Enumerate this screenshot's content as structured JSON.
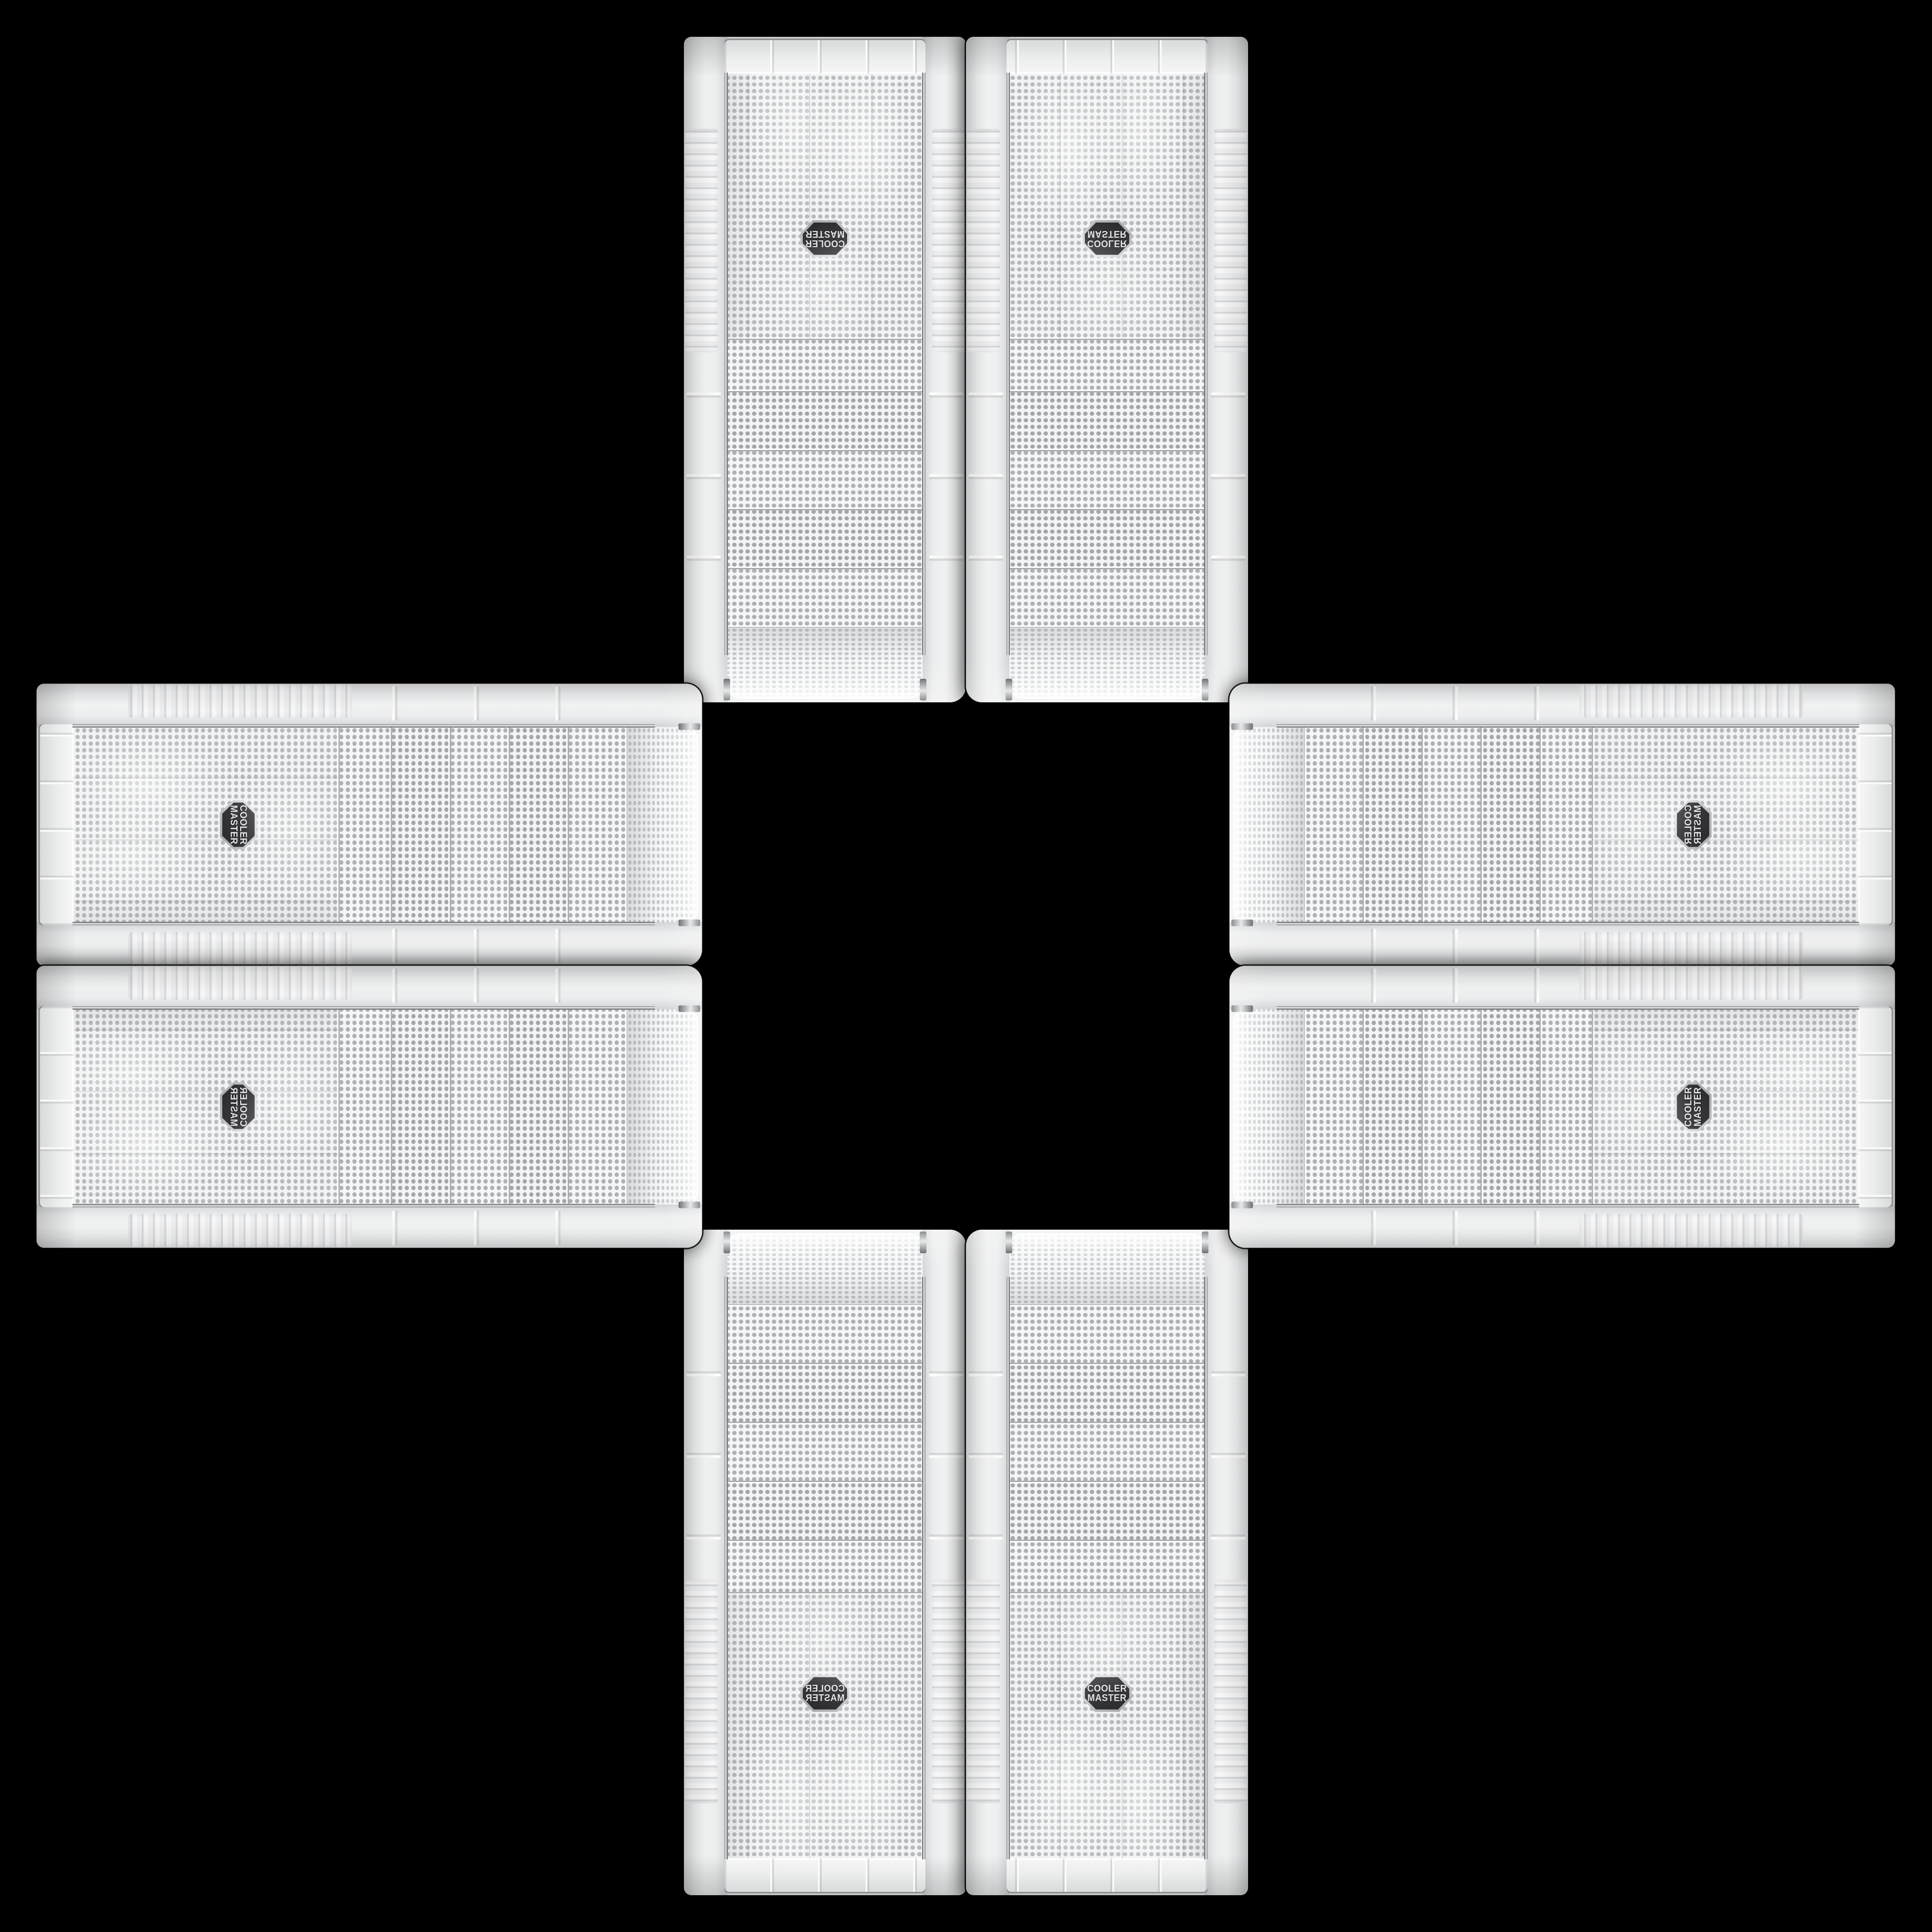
{
  "scene": {
    "type": "product-photo-collage",
    "description": "Eight identical white Cooler Master mid-tower PC case front panels arranged in a plus / cross mandala on a pure black background; panels are mirrored and rotated so the curved mesh ends all face the empty black center square",
    "background_color": "#000000",
    "panel_count": 8,
    "arrangement": [
      "top-left-vertical",
      "top-right-vertical",
      "left-top-horizontal",
      "right-top-horizontal",
      "left-bottom-horizontal",
      "right-bottom-horizontal",
      "bottom-left-vertical",
      "bottom-right-vertical"
    ]
  },
  "brand": {
    "logo_line1": "COOLER",
    "logo_line2": "MASTER",
    "badge_shape": "hexagon",
    "badge_color": "#3a3a3d",
    "badge_text_color": "#e3e4e5",
    "badge_trim_color": "#c3c5c7"
  },
  "panel": {
    "body_color": "#eef0f1",
    "rail_color": "#f2f3f4",
    "mesh_color": "#f2f3f4",
    "mesh_dot_color": "#b7babc",
    "drive_bay_count": 5,
    "bay_mesh_dot_color": "#a4a7aa",
    "chrome_trim_color": "#95979a",
    "cap_bar_color": "#eceded",
    "seam_color": "#000000"
  }
}
